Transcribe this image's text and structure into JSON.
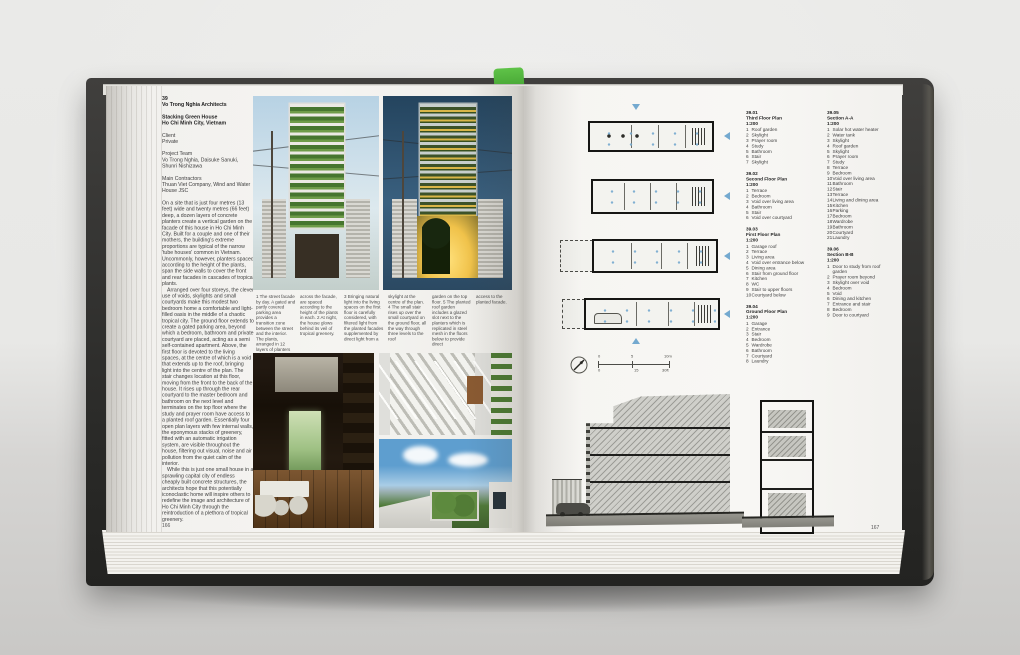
{
  "scene": {
    "description": "Open architecture monograph lying on a grey surface, green bookmark at spine",
    "bookmark_color": "#4fb53b",
    "annotation_color": "#74a9cf"
  },
  "left_page": {
    "page_number": "166",
    "project_number": "39",
    "architect": "Vo Trong Nghia Architects",
    "title": "Stacking Green House",
    "location": "Ho Chi Minh City, Vietnam",
    "client_label": "Client",
    "client": "Private",
    "team_label": "Project Team",
    "team": "Vo Trong Nghia, Daisuke Sanuki, Shunri Nishizawa",
    "contractors_label": "Main Contractors",
    "contractors": "Thuan Viet Company, Wind and Water House JSC",
    "body_paragraphs": [
      "On a site that is just four metres (13 feet) wide and twenty metres (66 feet) deep, a dozen layers of concrete planters create a vertical garden on the facade of this house in Ho Chi Minh City. Built for a couple and one of their mothers, the building's extreme proportions are typical of the narrow 'tube houses' common in Vietnam. Uncommonly, however, planters spaced according to the height of the plants, span the side walls to cover the front and rear facades in cascades of tropical plants.",
      "Arranged over four storeys, the clever use of voids, skylights and small courtyards make this modest two bedroom home a comfortable and light-filled oasis in the middle of a chaotic tropical city. The ground floor extends to create a gated parking area, beyond which a bedroom, bathroom and private courtyard are placed, acting as a semi self-contained apartment. Above, the first floor is devoted to the living spaces, at the centre of which is a void that extends up to the roof, bringing light into the centre of the plan. The stair changes location at this floor, moving from the front to the back of the house. It rises up through the rear courtyard to the master bedroom and bathroom on the next level and terminates on the top floor where the study and prayer room have access to a planted roof garden. Essentially four open plan layers with few internal walls, the eponymous stacks of greenery, fitted with an automatic irrigation system, are visible throughout the house, filtering out visual, noise and air pollution from the quiet calm of the interior.",
      "While this is just one small house in a sprawling capital city of endless cheaply built concrete structures, the architects hope that this potentially iconoclastic home will inspire others to redefine the image and architecture of Ho Chi Minh City through the reintroduction of a plethora of tropical greenery."
    ],
    "captions": [
      "1 The street facade by day. A gated and partly covered parking area provides a transition zone between the street and the interior. The plants, arranged in 12 layers of planters",
      "across the facade, are spaced according to the height of the plants in each. 2 At night, the house glows behind its veil of tropical greenery.",
      "3 Bringing natural light into the living spaces on the first floor is carefully considered, with filtered light from the planted facades supplemented by direct light from a",
      "skylight at the centre of the plan. 4 The small stair rises up over the small courtyard on the ground floor, all the way through three levels to the roof",
      "garden on the top floor. 5 The planted roof garden includes a glazed slot next to the planters which is replicated in steel mesh in the floors below to provide direct",
      "access to the planted facade."
    ],
    "photo_descriptions": [
      "street facade by day with stacked green planters",
      "street facade at night glowing behind planters",
      "first-floor living and dining interior",
      "stair rising through the house",
      "planted roof garden with sky"
    ]
  },
  "right_page": {
    "page_number": "167",
    "plan_legends": [
      {
        "id": "39.01",
        "title": "Third Floor Plan",
        "scale": "1:200",
        "items": [
          "Roof garden",
          "Skylight",
          "Prayer room",
          "Study",
          "Bathroom",
          "Stair",
          "Skylight"
        ]
      },
      {
        "id": "39.02",
        "title": "Second Floor Plan",
        "scale": "1:200",
        "items": [
          "Terrace",
          "Bedroom",
          "Void over living area",
          "Bathroom",
          "Stair",
          "Void over courtyard"
        ]
      },
      {
        "id": "39.03",
        "title": "First Floor Plan",
        "scale": "1:200",
        "items": [
          "Garage roof",
          "Terrace",
          "Living area",
          "Void over entrance below",
          "Dining area",
          "Stair from ground floor",
          "Kitchen",
          "WC",
          "Stair to upper floors",
          "Courtyard below"
        ]
      },
      {
        "id": "39.04",
        "title": "Ground Floor Plan",
        "scale": "1:200",
        "items": [
          "Garage",
          "Entrance",
          "Stair",
          "Bedroom",
          "Wardrobe",
          "Bathroom",
          "Courtyard",
          "Laundry"
        ]
      }
    ],
    "section_legends": [
      {
        "id": "39.05",
        "title": "Section A-A",
        "scale": "1:200",
        "items": [
          "Solar hot water heater",
          "Water tank",
          "Skylight",
          "Roof garden",
          "Skylight",
          "Prayer room",
          "Study",
          "Terrace",
          "Bedroom",
          "Void over living area",
          "Bathroom",
          "Stair",
          "Terrace",
          "Living and dining area",
          "Kitchen",
          "Parking",
          "Bedroom",
          "Wardrobe",
          "Bathroom",
          "Courtyard",
          "Laundry"
        ]
      },
      {
        "id": "39.06",
        "title": "Section B-B",
        "scale": "1:200",
        "items": [
          "Door to study from roof garden",
          "Prayer room beyond",
          "Skylight over void",
          "Bedroom",
          "Void",
          "Dining and kitchen",
          "Entrance and stair",
          "Bedroom",
          "Door to courtyard"
        ]
      }
    ],
    "scale_bar": {
      "metric": [
        "0",
        "5",
        "10m"
      ],
      "imperial": [
        "0",
        "15",
        "30ft"
      ]
    }
  }
}
